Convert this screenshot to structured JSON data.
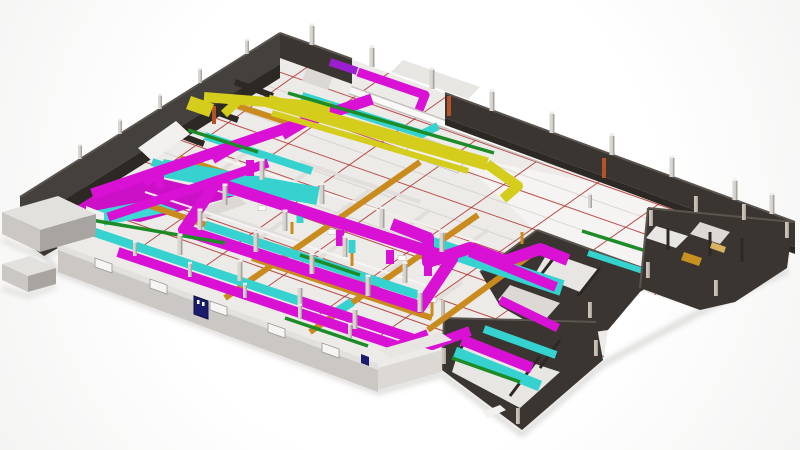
{
  "view": {
    "kind": "3d-bim-model-render",
    "subject": "isometric building floor plate with MEP ductwork"
  },
  "palette": {
    "background": "#fdfdfd",
    "floor": "#edebe8",
    "floor_bright": "#f5f4f2",
    "floor_patch_magenta": "#cc10c8",
    "floor_patch_cyan": "#3ed8d4",
    "wall_dark": "#3a3530",
    "wall_dark_inner": "#2c2824",
    "wall_dark_top": "#5a554f",
    "wall_nw": "#44403c",
    "wall_light": "#cbc8c4",
    "wall_light_top": "#e3e1de",
    "window_light": "#f6f5f3",
    "duct_magenta": "#d911d4",
    "duct_cyan": "#35d2cf",
    "duct_amber": "#c98a1e",
    "duct_yellow": "#d5cd1c",
    "duct_violet": "#9b1fd0",
    "pipe_green": "#1d8b28",
    "pipe_white": "#f7f6f4",
    "gridline_red": "#b03030",
    "gridline_gray": "#cfccc8",
    "partition": "#e0ddd9",
    "column": "#d9d6d1",
    "column_shade": "#a8a5a0",
    "column_tan": "#cbc1b4",
    "door_blue": "#1b1c6e",
    "accent_rust": "#b4532a",
    "stair_amber": "#c79023",
    "stair_tan": "#d8b25e",
    "shadow": "#d2d2d0"
  },
  "systems": [
    {
      "id": "ductwork-magenta",
      "color": "#d911d4"
    },
    {
      "id": "ductwork-cyan",
      "color": "#35d2cf"
    },
    {
      "id": "ductwork-amber",
      "color": "#c98a1e"
    },
    {
      "id": "ductwork-yellow",
      "color": "#d5cd1c"
    },
    {
      "id": "piping-green",
      "color": "#1d8b28"
    },
    {
      "id": "floor-gridlines-red",
      "color": "#b03030"
    }
  ]
}
